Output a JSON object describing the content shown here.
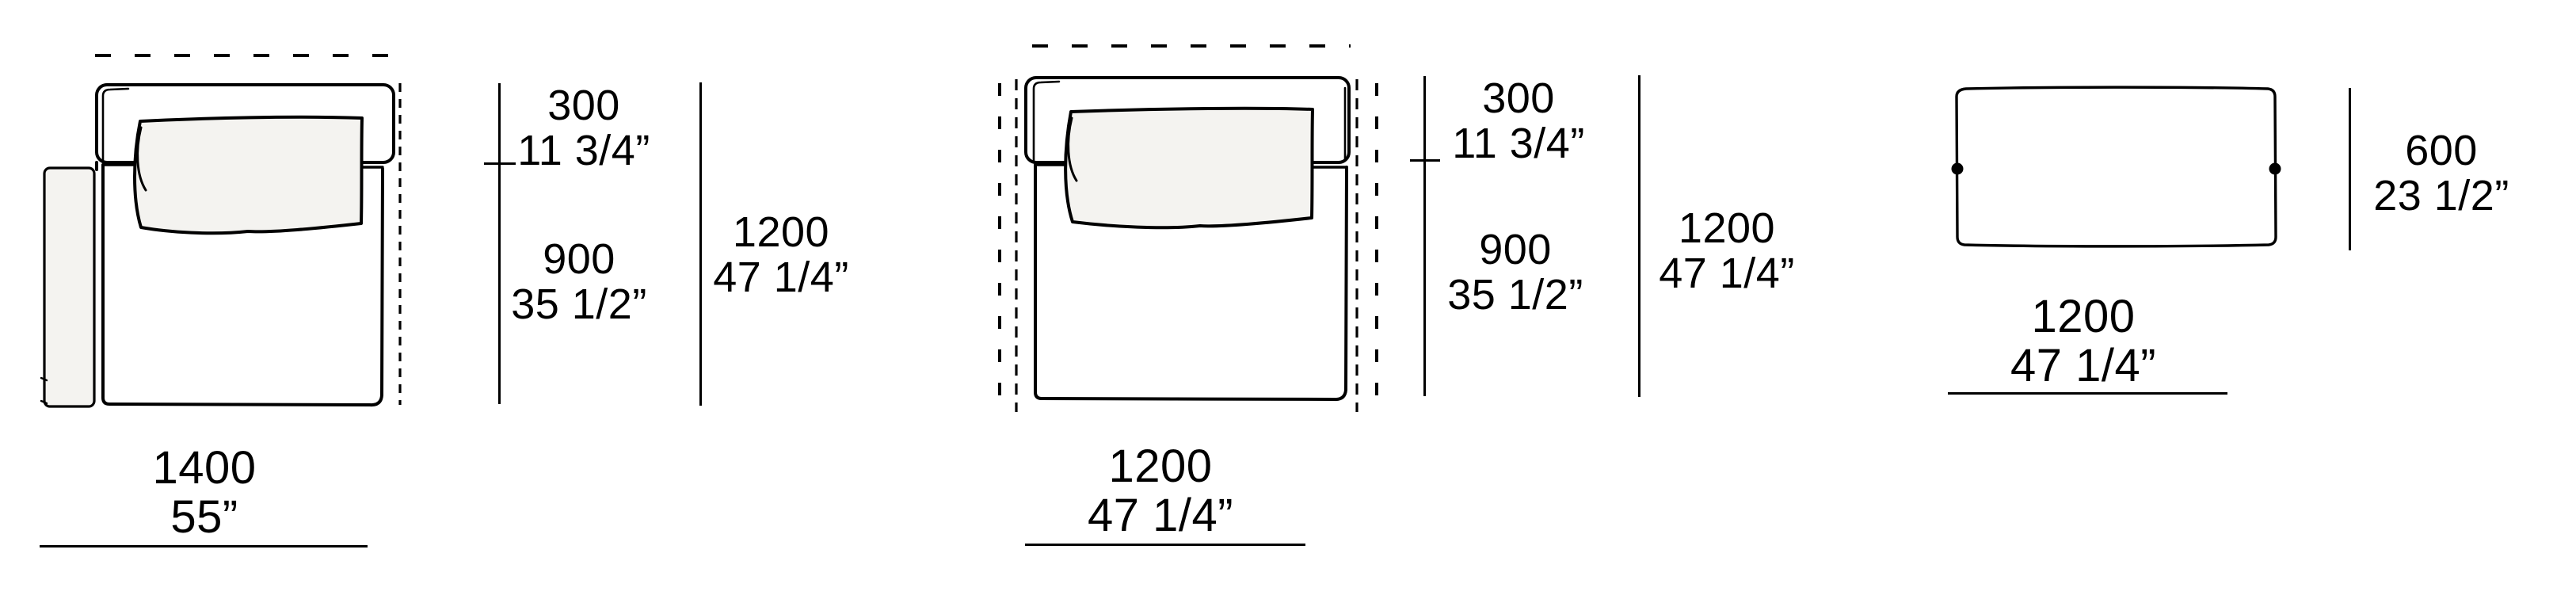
{
  "page": {
    "background": "#ffffff",
    "ink": "#000000",
    "cushion_fill": "#f4f3f0"
  },
  "modules": [
    {
      "name": "sofa-element-left-armrest",
      "width": {
        "mm": "1400",
        "inch": "55”"
      },
      "dims": {
        "backrest_depth": {
          "mm": "300",
          "inch": "11 3/4”"
        },
        "seat_depth": {
          "mm": "900",
          "inch": "35 1/2”"
        },
        "total_depth": {
          "mm": "1200",
          "inch": "47 1/4”"
        }
      }
    },
    {
      "name": "sofa-element-armless",
      "width": {
        "mm": "1200",
        "inch": "47 1/4”"
      },
      "dims": {
        "backrest_depth": {
          "mm": "300",
          "inch": "11 3/4”"
        },
        "seat_depth": {
          "mm": "900",
          "inch": "35 1/2”"
        },
        "total_depth": {
          "mm": "1200",
          "inch": "47 1/4”"
        }
      }
    },
    {
      "name": "bench-element",
      "width": {
        "mm": "1200",
        "inch": "47 1/4”"
      },
      "dims": {
        "depth": {
          "mm": "600",
          "inch": "23 1/2”"
        }
      }
    }
  ]
}
